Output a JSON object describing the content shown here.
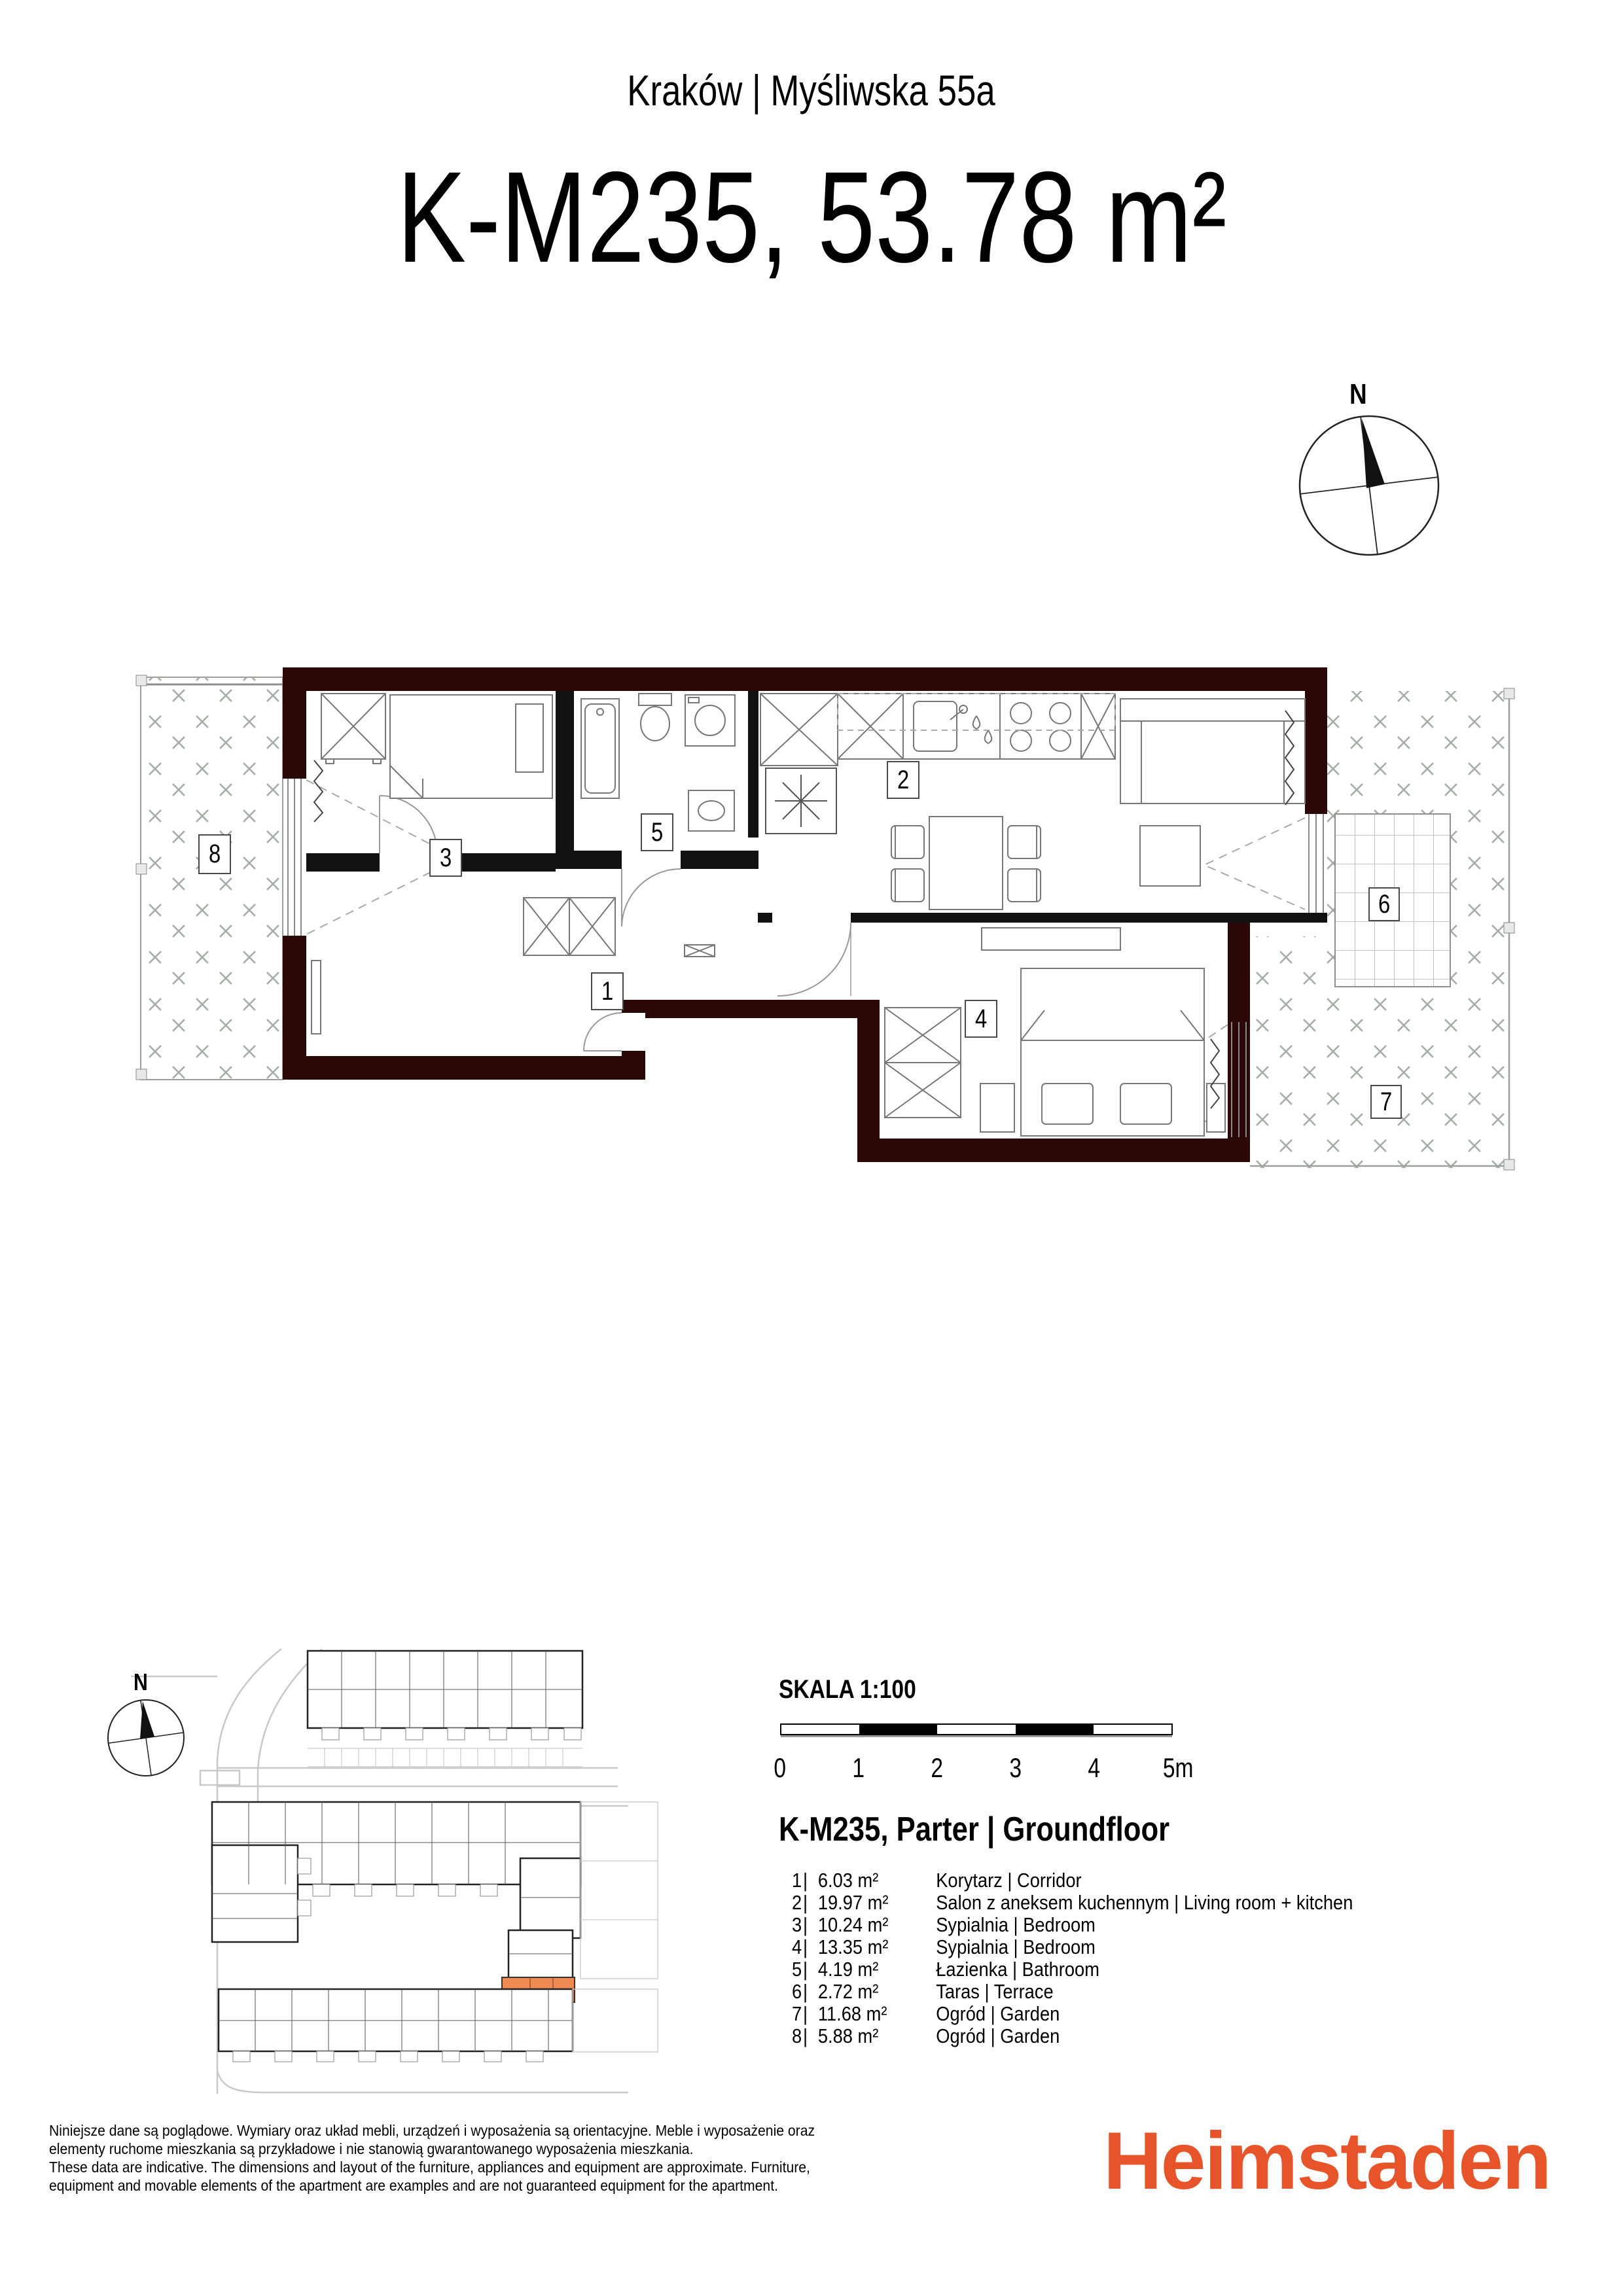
{
  "header": {
    "location": "Kraków | Myśliwska 55a",
    "unit_title": "K-M235, 53.78 m²"
  },
  "compass": {
    "north_label": "N"
  },
  "site_plan": {
    "compass_north_label": "N"
  },
  "scale": {
    "label": "SKALA 1:100",
    "ticks": [
      "0",
      "1",
      "2",
      "3",
      "4",
      "5m"
    ]
  },
  "floor_heading": "K-M235, Parter | Groundfloor",
  "legend": {
    "separator": "|",
    "rooms": [
      {
        "num": "1",
        "area": "6.03 m²",
        "label": "Korytarz  | Corridor"
      },
      {
        "num": "2",
        "area": "19.97 m²",
        "label": "Salon z aneksem kuchennym  | Living room + kitchen"
      },
      {
        "num": "3",
        "area": "10.24 m²",
        "label": "Sypialnia | Bedroom"
      },
      {
        "num": "4",
        "area": "13.35 m²",
        "label": "Sypialnia  | Bedroom"
      },
      {
        "num": "5",
        "area": "4.19 m²",
        "label": "Łazienka  | Bathroom"
      },
      {
        "num": "6",
        "area": "2.72 m²",
        "label": "Taras  | Terrace"
      },
      {
        "num": "7",
        "area": "11.68 m²",
        "label": "Ogród  | Garden"
      },
      {
        "num": "8",
        "area": "5.88 m²",
        "label": "Ogród | Garden"
      }
    ]
  },
  "footer": {
    "disclaimer_lines": [
      "Niniejsze dane są poglądowe. Wymiary oraz układ mebli, urządzeń i wyposażenia są orientacyjne. Meble i wyposażenie oraz",
      "elementy ruchome mieszkania są przykładowe i nie stanowią gwarantowanego wyposażenia mieszkania.",
      "These data are indicative. The dimensions and layout of the furniture, appliances and equipment are approximate. Furniture,",
      "equipment and movable elements of the apartment are examples and are not guaranteed equipment for the apartment."
    ],
    "brand": "Heimstaden"
  },
  "colors": {
    "brand_orange": "#E8542A",
    "unit_highlight": "#EF8B52",
    "exterior_wall": "#2B0808",
    "interior_wall": "#111111",
    "garden_hatch": "#A3ADA3"
  }
}
